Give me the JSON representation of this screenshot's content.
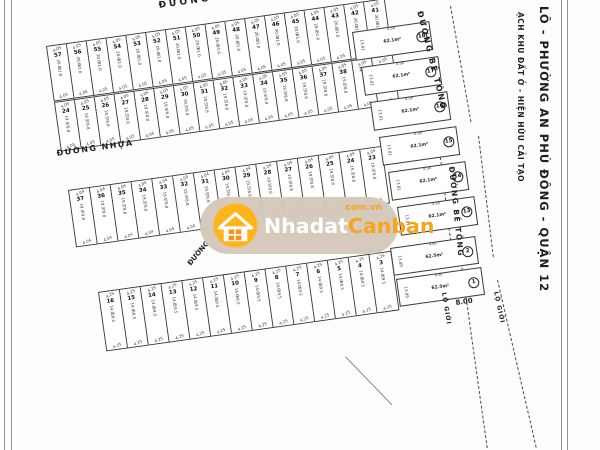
{
  "page": {
    "title_vertical": "LÔ - PHƯỜNG AN PHÚ ĐÔNG - QUẬN 12",
    "subtitle_vertical": "ẠCH KHU ĐẤT Ở - HIỆN HỮU CẢI TẠO"
  },
  "roads": {
    "top": "ĐƯỜNG NHỰA",
    "middle": "ĐƯỜNG NHỰA",
    "concrete_upper": "ĐƯỜNG BÊ TÔNG",
    "concrete_lower": "ĐƯỜNG BÊ TÔNG",
    "partial": "ĐƯỜNG",
    "boundary_left": "LỘ GIỚI",
    "boundary_right": "LỘ GIỚI",
    "boundary_width": "8.00"
  },
  "watermark": {
    "brand_white": "Nhadat",
    "brand_orange": "Canban",
    "domain": "com.vn",
    "pill_color": "#d5c8ba",
    "orange": "#f7a41d"
  },
  "blocks": {
    "row1a": {
      "numbers": [
        "57",
        "56",
        "55",
        "54",
        "53",
        "52",
        "51",
        "50",
        "49",
        "48",
        "47",
        "46",
        "45",
        "44",
        "43",
        "42",
        "41"
      ],
      "dim_top": "4.05",
      "side_dim": "20.0",
      "area": "81.0",
      "dim_bottom": "4.05"
    },
    "row1b": {
      "numbers": [
        "24",
        "25",
        "26",
        "27",
        "28",
        "29",
        "30",
        "31",
        "32",
        "33",
        "34",
        "35",
        "36",
        "37",
        "38",
        "39",
        "40"
      ],
      "dim_top": "4.05",
      "side_dim": "19.5",
      "area": "78.8",
      "dim_bottom": "4.05"
    },
    "row2": {
      "numbers": [
        "37",
        "36",
        "35",
        "34",
        "33",
        "32",
        "31",
        "30",
        "29",
        "28",
        "27",
        "26",
        "25",
        "24",
        "23"
      ],
      "dim_top": "4.04",
      "side_dim": "19.5",
      "area": "78.8",
      "dim_bottom": "4.04"
    },
    "row3": {
      "numbers": [
        "16",
        "15",
        "14",
        "13",
        "12",
        "11",
        "10",
        "9",
        "8",
        "7",
        "6",
        "5",
        "4",
        "3"
      ],
      "dim_top": "4.25",
      "side_dim": "14.0",
      "area": "59.5",
      "dim_bottom": "4.25"
    },
    "right_column": {
      "numbers": [
        "18",
        "17",
        "16",
        "15",
        "14",
        "13"
      ],
      "edge_dim": "4.58",
      "depth_dim": "13.81",
      "area": "62.1m²"
    },
    "corner": {
      "numbers": [
        "2",
        "1"
      ],
      "edge_dim": "4.50",
      "depth_dim": "13.89",
      "area": "62.5m²"
    }
  }
}
